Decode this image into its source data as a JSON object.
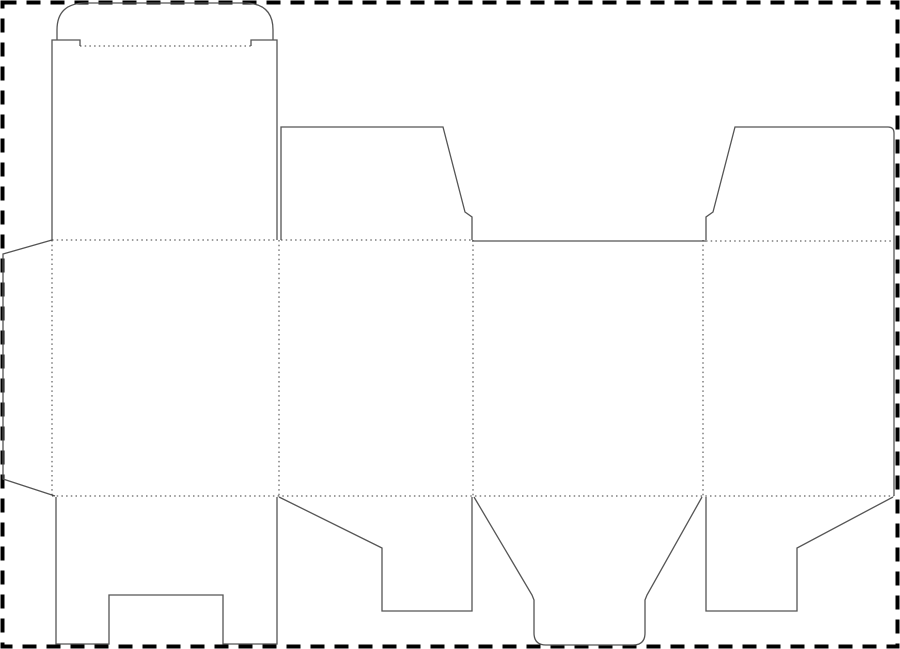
{
  "canvas": {
    "width": 900,
    "height": 649,
    "background": "#ffffff"
  },
  "colors": {
    "cut": "#555555",
    "fold": "#3c3c3c",
    "border": "#000000"
  },
  "line_styles": {
    "cut": {
      "width": 1.3,
      "dash": "none",
      "meaning": "cut line"
    },
    "fold": {
      "width": 1,
      "dash": "1.5 3.2",
      "meaning": "fold / crease line"
    },
    "border": {
      "width": 4,
      "dash": "14 10",
      "meaning": "sheet boundary"
    }
  },
  "dieline": {
    "description": "folding-carton die-cut template: glue flap, four body panels, tuck lid with rounded tuck flap, top and bottom dust flaps, bottom tuck tongue, notched bottom closure flap",
    "paths": [
      {
        "name": "sheet-border",
        "kind": "border",
        "d": "M2.5,2.5 H897.5 V646.5 H2.5 Z"
      },
      {
        "name": "tuck-flap-outline",
        "kind": "cut",
        "d": "M57,40 L57,30 Q57,3 86,3 L244,3 Q273,3 273,30 L273,40"
      },
      {
        "name": "lid-left-edge",
        "kind": "cut",
        "d": "M52,240 L52,40 L80,40 L80,46"
      },
      {
        "name": "lid-right-edge",
        "kind": "cut",
        "d": "M277,240 L277,40 L251,40 L251,46"
      },
      {
        "name": "tuck-fold",
        "kind": "fold",
        "d": "M80,46 L251,46"
      },
      {
        "name": "lid-bottom-fold",
        "kind": "fold",
        "d": "M52,240 L277,240"
      },
      {
        "name": "glue-flap-outline",
        "kind": "cut",
        "d": "M52,240 L3,254 L3,479 L55,496"
      },
      {
        "name": "glue-flap-fold",
        "kind": "fold",
        "d": "M52,240 L52,496"
      },
      {
        "name": "top-fold-panel2",
        "kind": "fold",
        "d": "M281,240 L472,240"
      },
      {
        "name": "top-dust-flap-left-outline",
        "kind": "cut",
        "d": "M281,240 L281,127 L443,127 L465,212 L472,217 L472,240"
      },
      {
        "name": "panel3-top-cut",
        "kind": "cut",
        "d": "M472,241 L706,241"
      },
      {
        "name": "top-dust-flap-right-outline",
        "kind": "cut",
        "d": "M706,240 L706,217 L713,212 L735,127 L888,127 Q894,127 894,133 L894,496"
      },
      {
        "name": "top-fold-panel4",
        "kind": "fold",
        "d": "M706,241 L894,241"
      },
      {
        "name": "fold-panel1-panel2",
        "kind": "fold",
        "d": "M279,240 L279,496"
      },
      {
        "name": "fold-panel2-panel3",
        "kind": "fold",
        "d": "M473,240 L473,496"
      },
      {
        "name": "fold-panel3-panel4",
        "kind": "fold",
        "d": "M703,240 L703,496"
      },
      {
        "name": "bottom-fold",
        "kind": "fold",
        "d": "M52,496 L894,496"
      },
      {
        "name": "bottom-notched-flap-outline",
        "kind": "cut",
        "d": "M56,497 L56,644 L109,644 L109,595 L223,595 L223,644 L277,644 L277,497"
      },
      {
        "name": "bottom-dust-flap-left-outline",
        "kind": "cut",
        "d": "M279,497 L382,548 L382,611 L472,611 L472,497"
      },
      {
        "name": "bottom-tuck-tongue-outline",
        "kind": "cut",
        "d": "M474,497 L532,595 L534,600 L534,633 Q534,645 546,645 L633,645 Q645,645 645,633 L645,600 L647,595 L702,497"
      },
      {
        "name": "bottom-dust-flap-right-outline",
        "kind": "cut",
        "d": "M706,497 L706,611 L797,611 L797,548 L893,497"
      }
    ]
  }
}
